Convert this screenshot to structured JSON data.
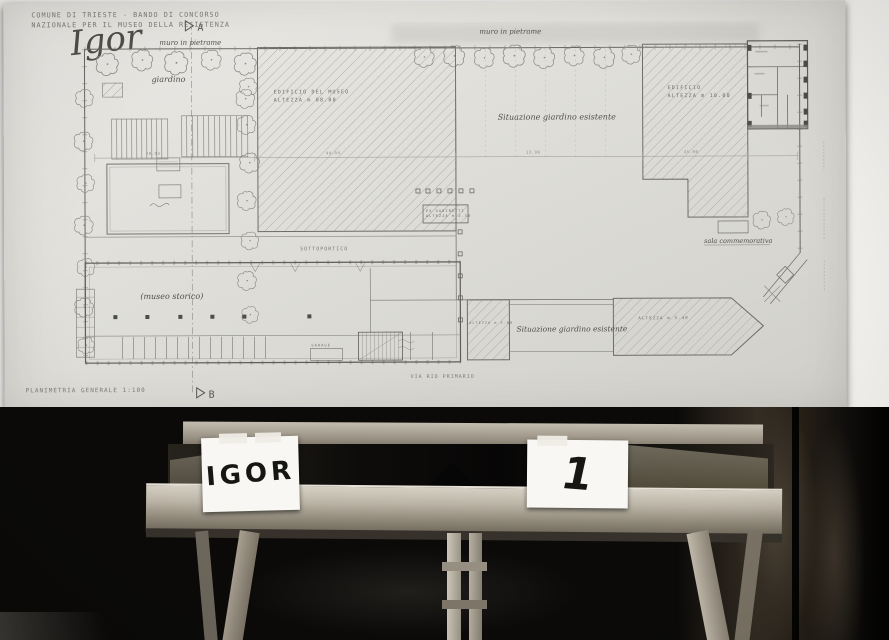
{
  "sheet": {
    "header": {
      "line1": "COMUNE DI TRIESTE - BANDO DI CONCORSO",
      "line2": "NAZIONALE PER IL MUSEO DELLA RESISTENZA"
    },
    "motto": "Igor",
    "markers": {
      "a": "A",
      "b": "B"
    },
    "title": {
      "label": "PLANIMETRIA GENERALE",
      "scale": "1:100"
    },
    "labels": {
      "wall_left": "muro in pietrame",
      "wall_center": "muro in pietrame",
      "garden": "giardino",
      "museum1": "EDIFICIO DEL MUSEO",
      "museum2": "ALTEZZA m 08.00",
      "building1": "EDIFICIO",
      "building2": "ALTEZZA m 10.00",
      "annex1": "EX GABINETTI",
      "annex2": "ALTEZZA m 2.50",
      "garden_center": "Situazione giardino esistente",
      "garden_bottom": "Situazione giardino esistente",
      "sottoportico": "SOTTOPORTICO",
      "historic": "(museo storico)",
      "memorial": "sala commemorativa",
      "garage": "GARAGE",
      "block_left": "ALTEZZA m 3.00",
      "block_right": "ALTEZZA m 3.40",
      "street": "VIA RIO PRIMARIO"
    },
    "dims": {
      "d1": "20.03",
      "d2": "44.04",
      "d3": "13.96",
      "d4": "45.06"
    }
  },
  "easel": {
    "card_left": "IGOR",
    "card_right": "1"
  },
  "colors": {
    "paper": "#e4e3de",
    "ink": "#6b6964",
    "room": "#0b0a09",
    "wood": "#b3ac9f"
  }
}
